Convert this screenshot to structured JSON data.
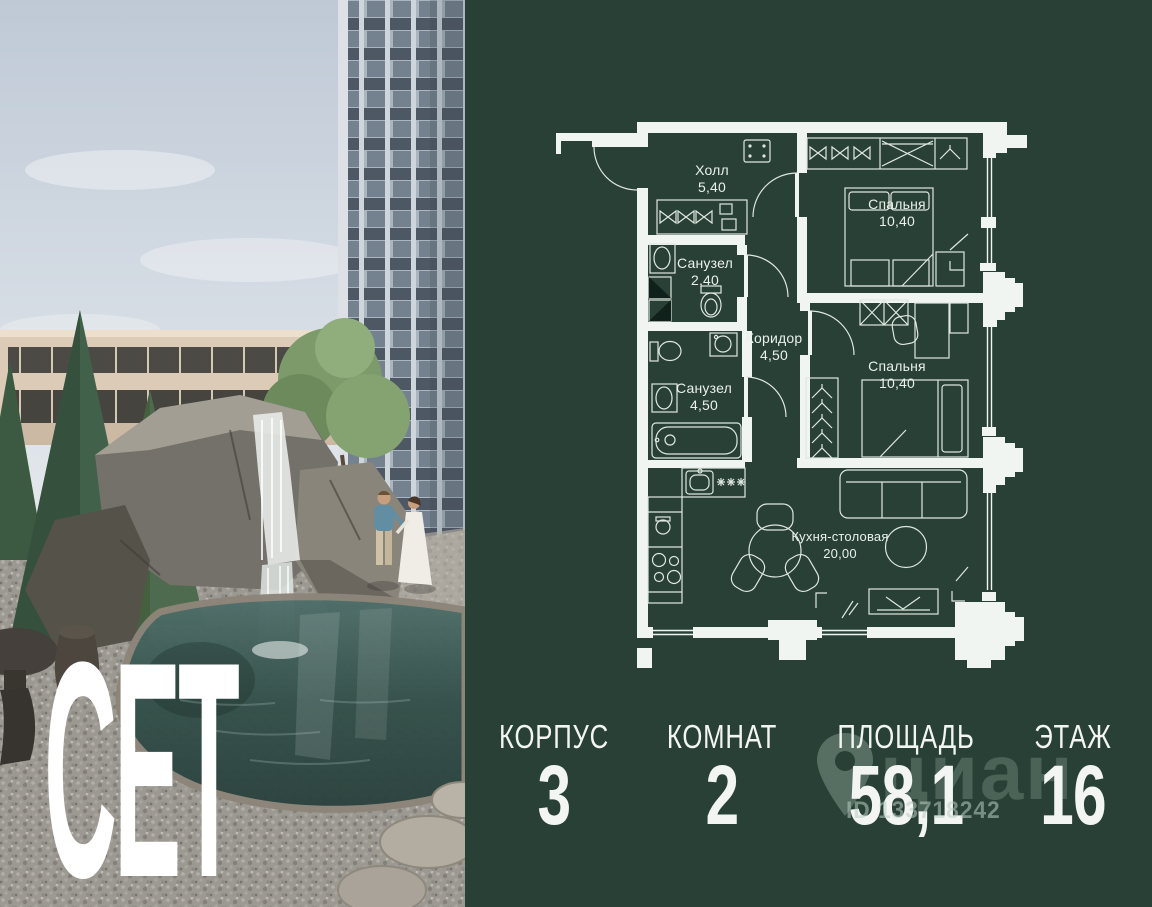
{
  "brand": {
    "logo": "СЕТ"
  },
  "colors": {
    "panel_background": "#294036",
    "plan_lines": "#f1f5f1",
    "stats_text": "#f2f5f2",
    "watermark": "#b9cec2"
  },
  "plan": {
    "rooms": [
      {
        "name": "Холл",
        "area": "5,40"
      },
      {
        "name": "Спальня",
        "area": "10,40"
      },
      {
        "name": "Санузел",
        "area": "2,40"
      },
      {
        "name": "Коридор",
        "area": "4,50"
      },
      {
        "name": "Санузел",
        "area": "4,50"
      },
      {
        "name": "Спальня",
        "area": "10,40"
      },
      {
        "name": "Кухня-столовая",
        "area": "20,00"
      }
    ]
  },
  "stats": {
    "items": [
      {
        "label": "КОРПУС",
        "value": "3"
      },
      {
        "label": "КОМНАТ",
        "value": "2"
      },
      {
        "label": "ПЛОЩАДЬ",
        "value": "58,1"
      },
      {
        "label": "ЭТАЖ",
        "value": "16"
      }
    ]
  },
  "watermark": {
    "logo": "циан",
    "id_text": "ID 133718242"
  }
}
